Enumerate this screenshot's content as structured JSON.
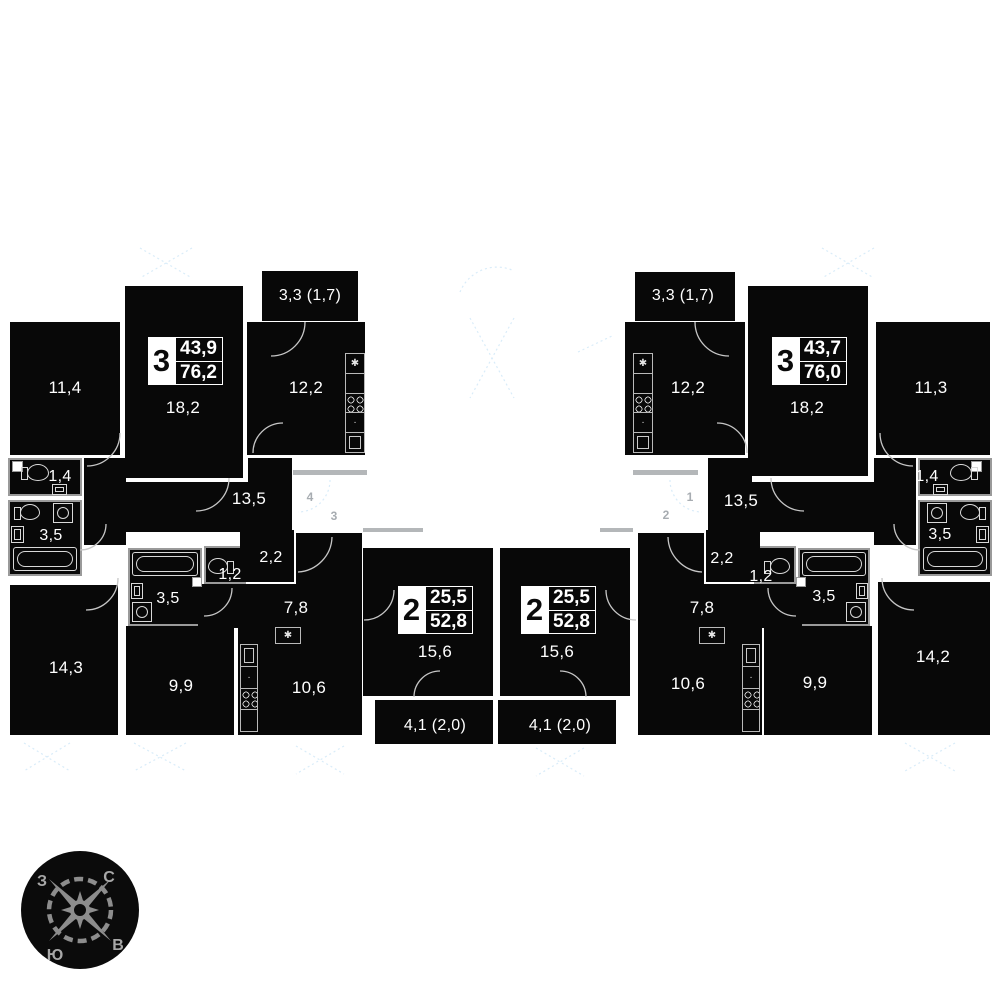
{
  "palette": {
    "room_fill": "#080808",
    "wall_gray": "#9a9a9a",
    "fixture_line": "#d8d8d8",
    "corridor_bar": "#b4b7b9",
    "faint_blue": "#d9ecf9",
    "mark_gray": "#a7acb1",
    "text_white": "#ffffff"
  },
  "icons": {
    "kitchen_sink": "✱",
    "faucet": "·"
  },
  "corridor": {
    "marks_left": [
      "4",
      "3"
    ],
    "marks_right": [
      "1",
      "2"
    ]
  },
  "compass": {
    "west": "З",
    "north": "С",
    "south": "Ю",
    "east": "В"
  },
  "apartments": {
    "left3": {
      "badge": "3",
      "living_area": "43,9",
      "total_area": "76,2",
      "rooms": {
        "bedroom": "11,4",
        "living": "18,2",
        "balcony": "3,3 (1,7)",
        "kitchen": "12,2",
        "wc": "1,4",
        "bath": "3,5",
        "hall": "13,5",
        "bedroom2": "14,3"
      }
    },
    "left2": {
      "badge": "2",
      "living_area": "25,5",
      "total_area": "52,8",
      "rooms": {
        "bath": "3,5",
        "wc": "1,2",
        "storage": "2,2",
        "hall": "7,8",
        "bedroom": "9,9",
        "kitchen": "10,6",
        "living": "15,6",
        "balcony": "4,1 (2,0)"
      }
    },
    "right2": {
      "badge": "2",
      "living_area": "25,5",
      "total_area": "52,8",
      "rooms": {
        "bath": "3,5",
        "wc": "1,2",
        "storage": "2,2",
        "hall": "7,8",
        "bedroom": "9,9",
        "kitchen": "10,6",
        "living": "15,6",
        "balcony": "4,1 (2,0)"
      }
    },
    "right3": {
      "badge": "3",
      "living_area": "43,7",
      "total_area": "76,0",
      "rooms": {
        "bedroom": "11,3",
        "living": "18,2",
        "balcony": "3,3 (1,7)",
        "kitchen": "12,2",
        "wc": "1,4",
        "bath": "3,5",
        "hall": "13,5",
        "bedroom2": "14,2"
      }
    }
  }
}
